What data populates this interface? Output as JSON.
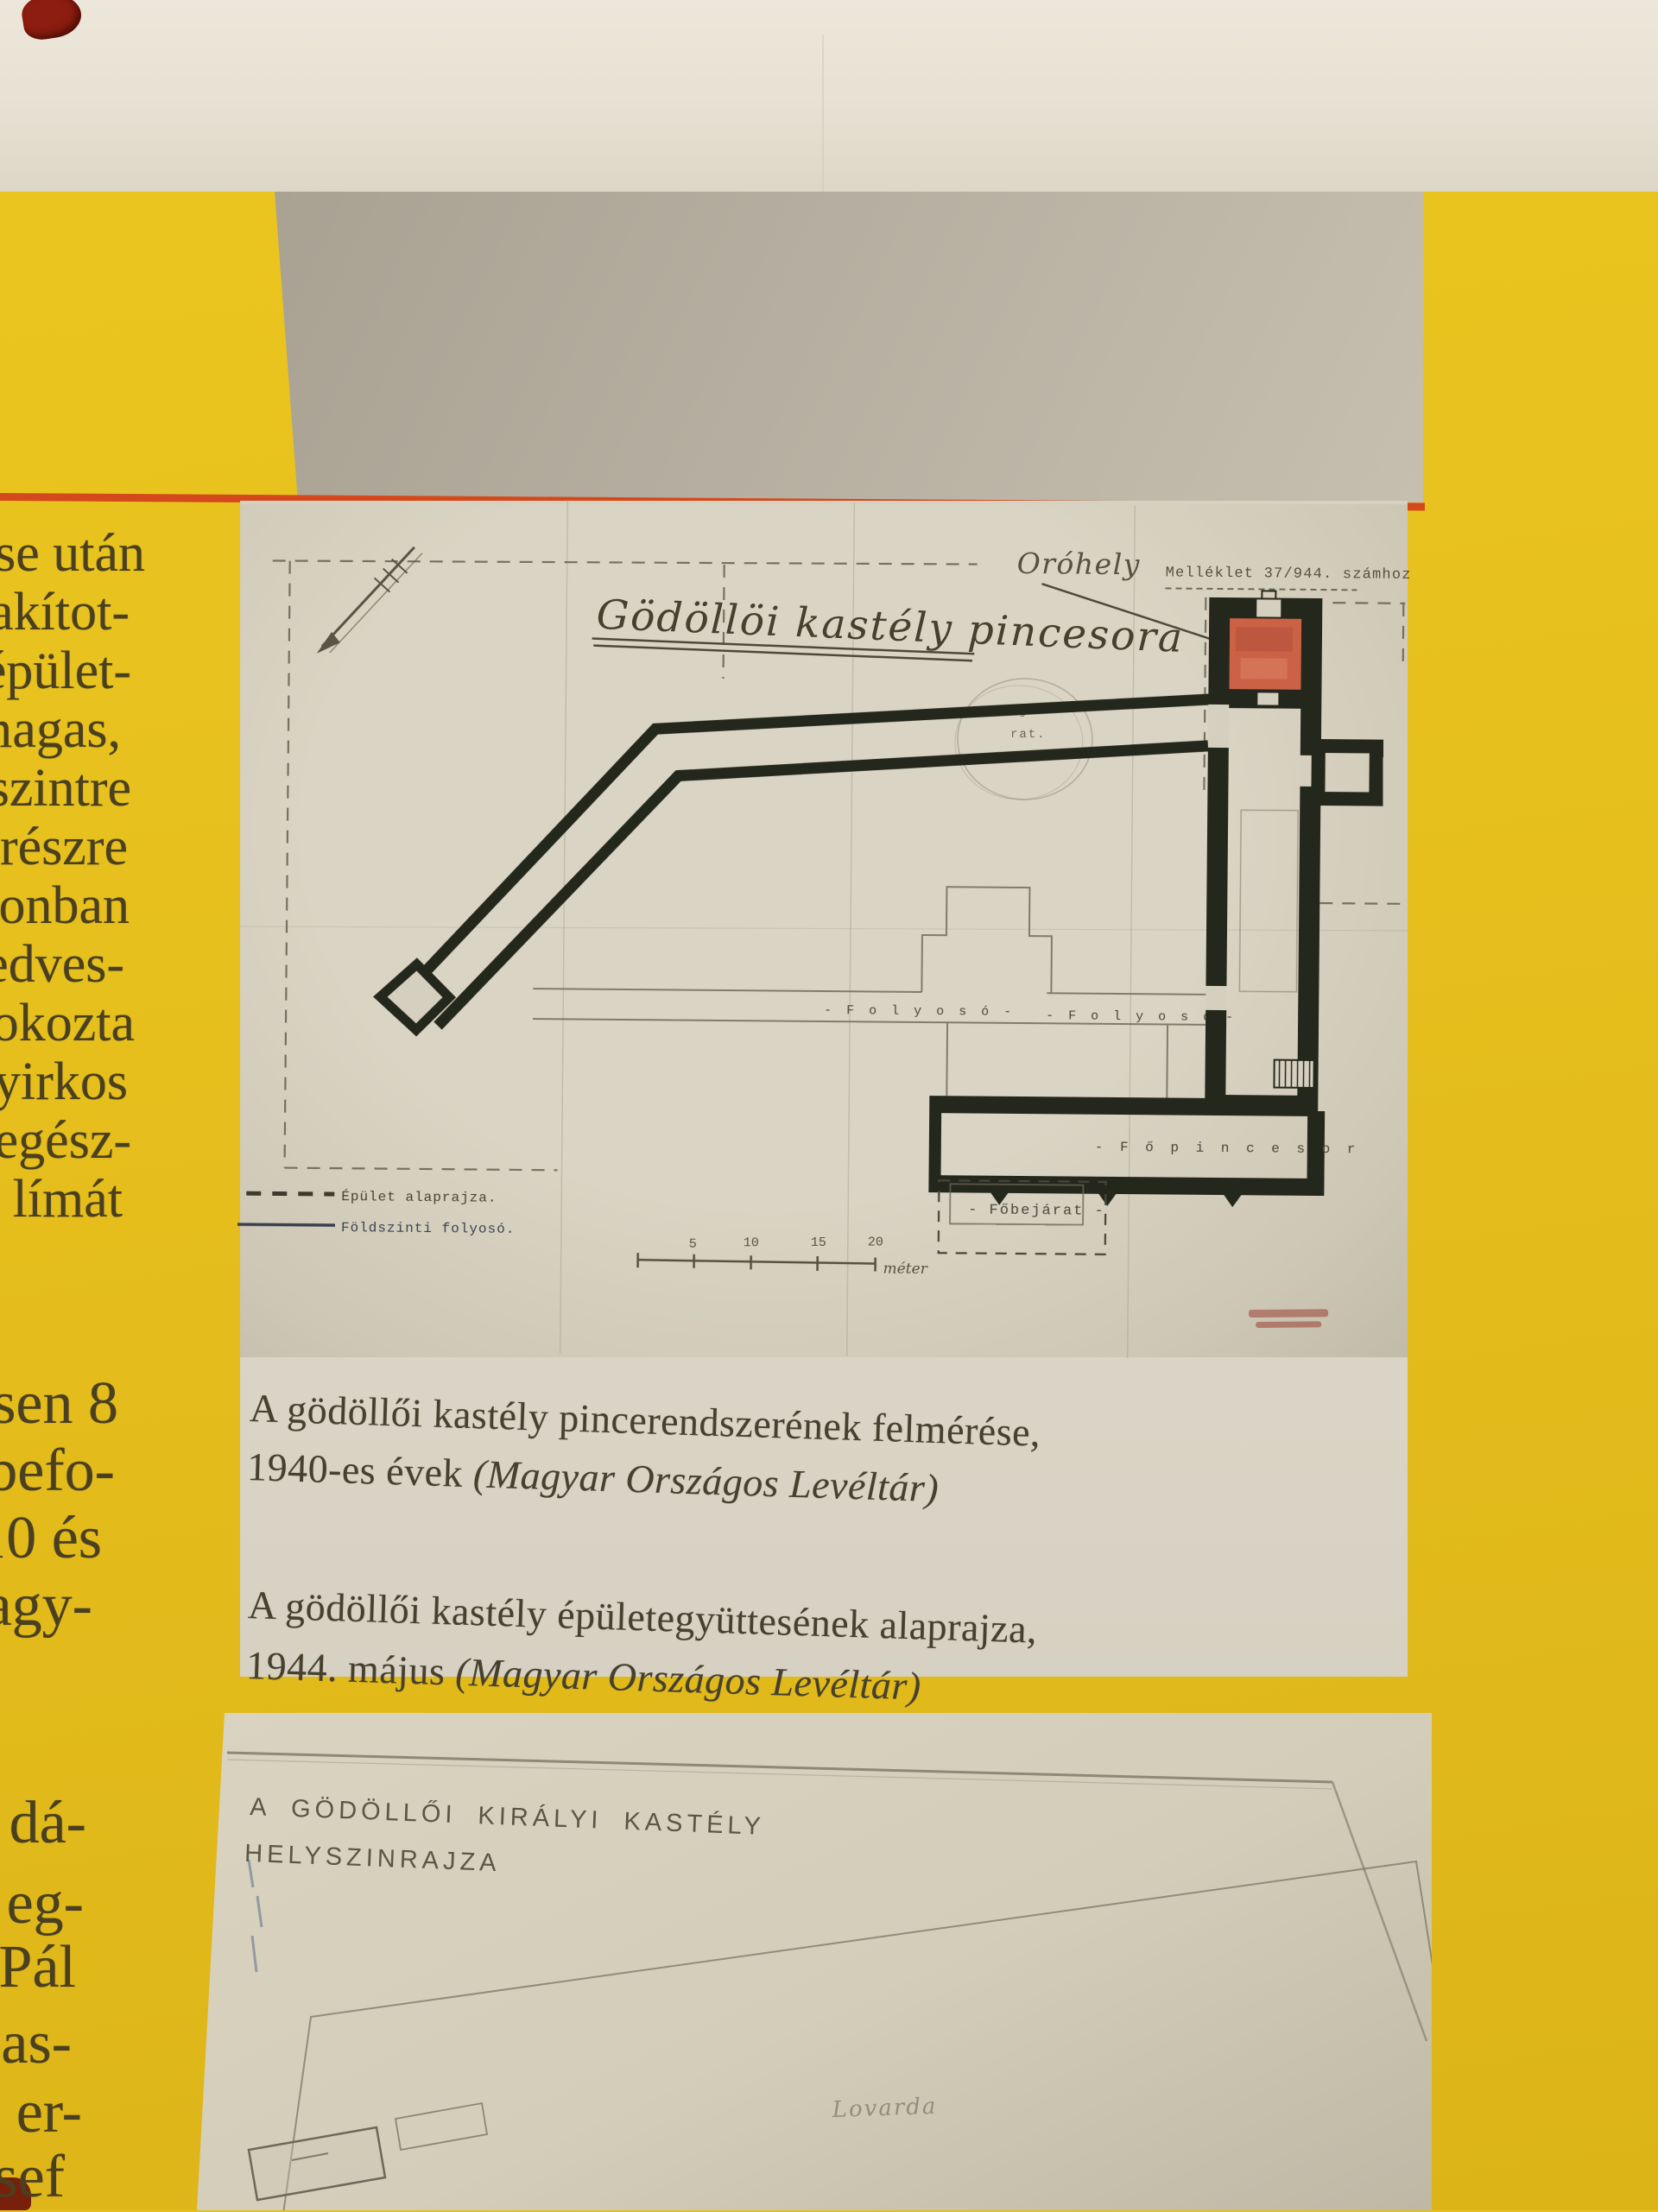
{
  "colors": {
    "page_yellow": "#e6bf1f",
    "wall_cream": "#e8e2d4",
    "gray_sheet": "#b6aea0",
    "red_rule": "#d4491b",
    "plan_paper": "#d6d0c0",
    "drawing_ink": "#24271c",
    "stamp_red": "#cb6246",
    "caption_text": "#46412f"
  },
  "left_margin_fragments": {
    "group1": [
      "ése után",
      "alakítot-",
      "épület-",
      "magas,",
      "szintre",
      "részre",
      "zonban",
      "edves-",
      "okozta",
      "yirkos",
      "egész-",
      "límát"
    ],
    "group2": [
      "sen 8",
      "befo-",
      "10 és",
      "agy-"
    ],
    "group3": [
      "dá-",
      "eg-",
      "Pál",
      "as-",
      "er-",
      "sef"
    ]
  },
  "plan": {
    "title": "Gödöllöi kastély pincesora",
    "note_handwritten": "Oróhely",
    "ref_typed": "Melléklet 37/944. számhoz",
    "label_bejarat_line1": "Bejá-",
    "label_bejarat_line2": "rat.",
    "label_folyoso": "- F o l y o s ó -",
    "label_fopince": "- F ő p i n c e s o r",
    "label_fobejarat": "- Főbejárat -",
    "legend": {
      "dashed_label": "Épület alaprajza.",
      "solid_label": "Földszinti folyosó."
    },
    "scale": {
      "tick1": "5",
      "tick2": "10",
      "tick3": "15",
      "tick4": "20",
      "unit": "méter"
    }
  },
  "captions": {
    "c1_line1": "A gödöllői kastély pincerendszerének felmérése,",
    "c1_line2_prefix": "1940-es évek ",
    "c1_line2_source": "(Magyar Országos Levéltár)",
    "c2_line1": "A gödöllői kastély épületegyüttesének alaprajza,",
    "c2_line2_prefix": "1944. május ",
    "c2_line2_source": "(Magyar Országos Levéltár)"
  },
  "site_plan": {
    "title_line1": "A GÖDÖLLŐI KIRÁLYI KASTÉLY",
    "title_line2": "HELYSZINRAJZA",
    "label_lovarda": "Lovarda"
  }
}
